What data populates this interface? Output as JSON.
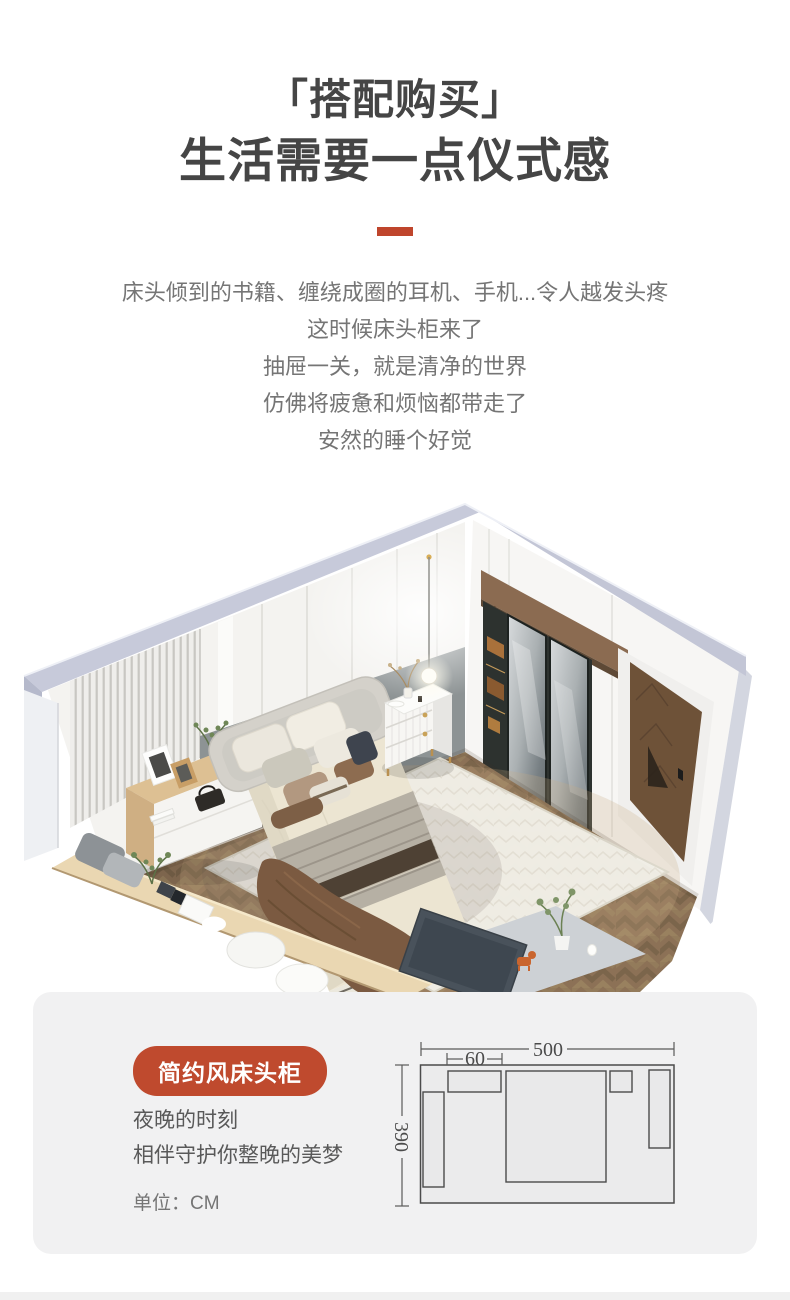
{
  "header": {
    "title_line1": "「搭配购买」",
    "title_line2": "生活需要一点仪式感",
    "divider_color": "#bf452c"
  },
  "intro": {
    "lines": [
      "床头倾到的书籍、缠绕成圈的耳机、手机...令人越发头疼",
      "这时候床头柜来了",
      "抽屉一关，就是清净的世界",
      "仿佛将疲惫和烦恼都带走了",
      "安然的睡个好觉"
    ]
  },
  "card": {
    "badge_label": "简约风床头柜",
    "desc_lines": [
      "夜晚的时刻",
      "相伴守护你整晚的美梦"
    ],
    "unit_label": "单位：CM",
    "background": "#f1f1f2",
    "badge_color": "#bf4a2e"
  },
  "floor_plan": {
    "width_cm": "500",
    "nightstand_width_cm": "60",
    "depth_cm": "390",
    "line_color": "#4b4b4b"
  },
  "colors": {
    "accent_red": "#bf452c",
    "title_text": "#454545",
    "body_text": "#757575",
    "wall_cap": "#c6c9d9",
    "floor_wood": "#8c7156"
  },
  "scene": {
    "elements": [
      "left-wall",
      "right-wall",
      "wardrobe",
      "door",
      "floor",
      "rug",
      "bed",
      "nightstand",
      "pendant-light",
      "dresser",
      "bench",
      "tv-bench"
    ]
  }
}
